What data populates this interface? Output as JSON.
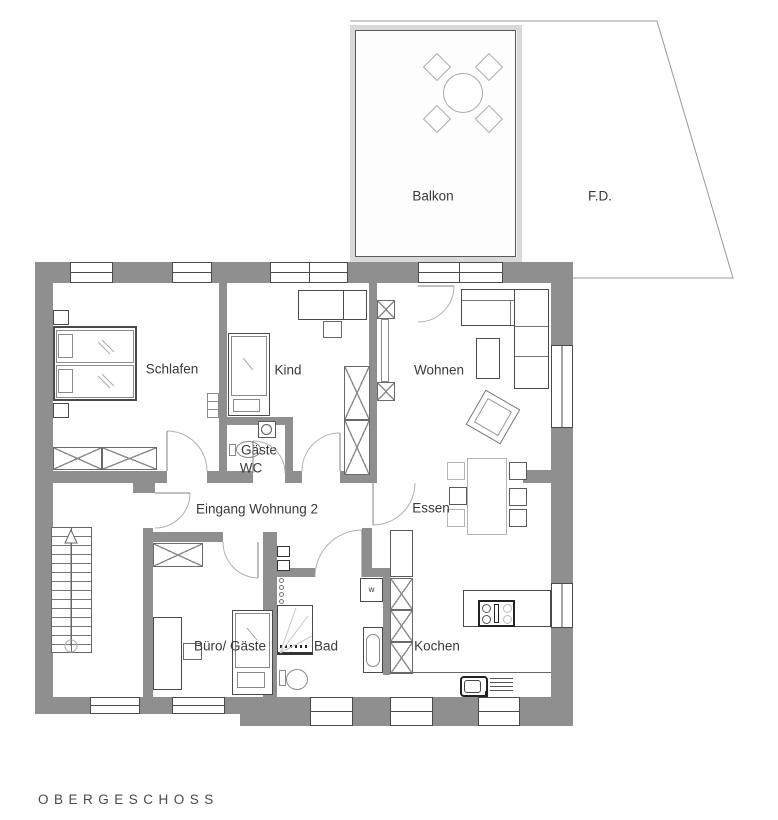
{
  "floor_plan": {
    "title": "OBERGESCHOSS",
    "rooms": {
      "balkon": "Balkon",
      "fd": "F.D.",
      "schlafen": "Schlafen",
      "kind": "Kind",
      "wohnen": "Wohnen",
      "gaeste_wc_line1": "Gäste",
      "gaeste_wc_line2": "WC",
      "eingang": "Eingang Wohnung 2",
      "essen": "Essen",
      "buero": "Büro/ Gäste",
      "bad": "Bad",
      "kochen": "Kochen"
    },
    "symbols": {
      "washer": "w"
    },
    "colors": {
      "wall": "#8f8f8f",
      "outline": "#4a4a4a",
      "light_furniture": "#b5b5b5",
      "balcony_frame": "#d9d9d9",
      "balcony_fill": "#f4f4f4"
    }
  }
}
